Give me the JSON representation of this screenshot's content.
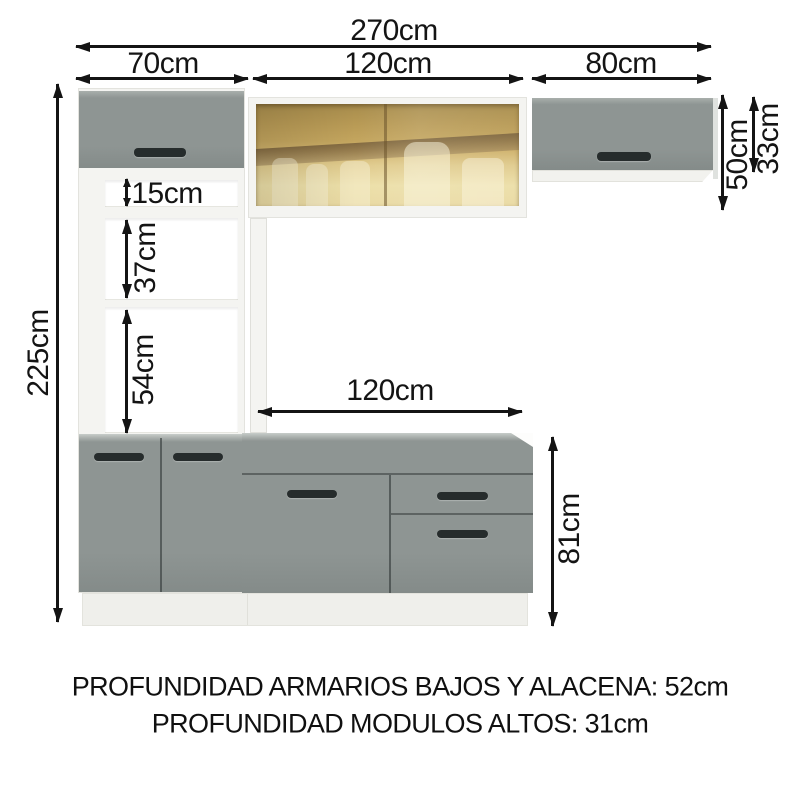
{
  "dims": {
    "total_width": "270cm",
    "tall_cabinet_width": "70cm",
    "center_top_width": "120cm",
    "right_cabinet_width": "80cm",
    "total_height": "225cm",
    "niche_1_height": "15cm",
    "niche_2_height": "37cm",
    "niche_3_height": "54cm",
    "counter_span": "120cm",
    "right_cabinet_height": "50cm",
    "right_cabinet_door_height": "33cm",
    "base_cabinet_height": "81cm"
  },
  "notes": {
    "line1": "PROFUNDIDAD ARMARIOS BAJOS Y ALACENA: 52cm",
    "line2": "PROFUNDIDAD MODULOS ALTOS: 31cm"
  },
  "colors": {
    "door-grey": "#8e9593",
    "door-grey-dark": "#848b89",
    "door-grey-light": "#a9afac",
    "handle-dark": "#262c2c",
    "frame-white": "#f4f4f1",
    "plinth-white": "#efefeb",
    "glass-amber": "#c3a55e",
    "glass-amber-light": "#ecdfa8",
    "glass-band-brown": "#8a7358",
    "dim": "#141414"
  }
}
